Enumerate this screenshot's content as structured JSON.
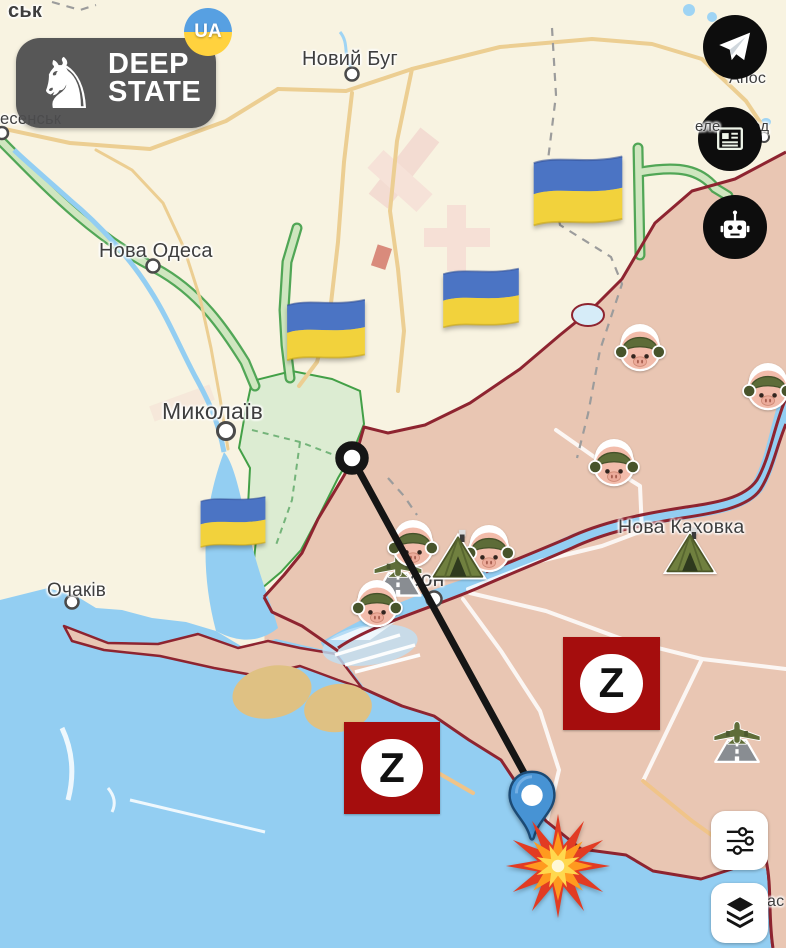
{
  "logo": {
    "line1": "DEEP",
    "line2": "STATE",
    "badge": "UA",
    "knight_icon": "♞"
  },
  "map": {
    "labels": {
      "city_fragment_top_left": "ськ",
      "voznesensk_fragment": "есенськ",
      "novyi_buh": "Новий Буг",
      "nova_odesa": "Нова Одеса",
      "mykolaiv": "Миколаїв",
      "ochakiv": "Очаків",
      "kherson_fragment": "ерсон",
      "nova_kakhovka": "Нова Каховка",
      "apostolove_fragment": "Апос",
      "zelenodolsk_fragment_left": "еле",
      "zelenodolsk_fragment_right": "од",
      "coast_fragment_bottom_right": "ас"
    },
    "z_label": "Z",
    "colors": {
      "occupied_fill": "#e9c6b3",
      "liberated_fill": "#dcecd2",
      "water_fill": "#93cef2",
      "frontline_stroke": "#8e2430",
      "z_badge_bg": "#a50d0d",
      "flag_blue": "#4b74c4",
      "flag_yellow": "#f2d23c"
    },
    "icons": {
      "telegram": "paper-plane",
      "news": "newspaper",
      "bot": "robot-head",
      "filters": "sliders",
      "layers": "layer-stack",
      "strike_markers": [
        "origin-ring",
        "location-pin",
        "explosion"
      ],
      "emoji_markers": [
        "ukraine-flag",
        "pig-soldier",
        "military-tent",
        "military-airfield"
      ]
    }
  }
}
